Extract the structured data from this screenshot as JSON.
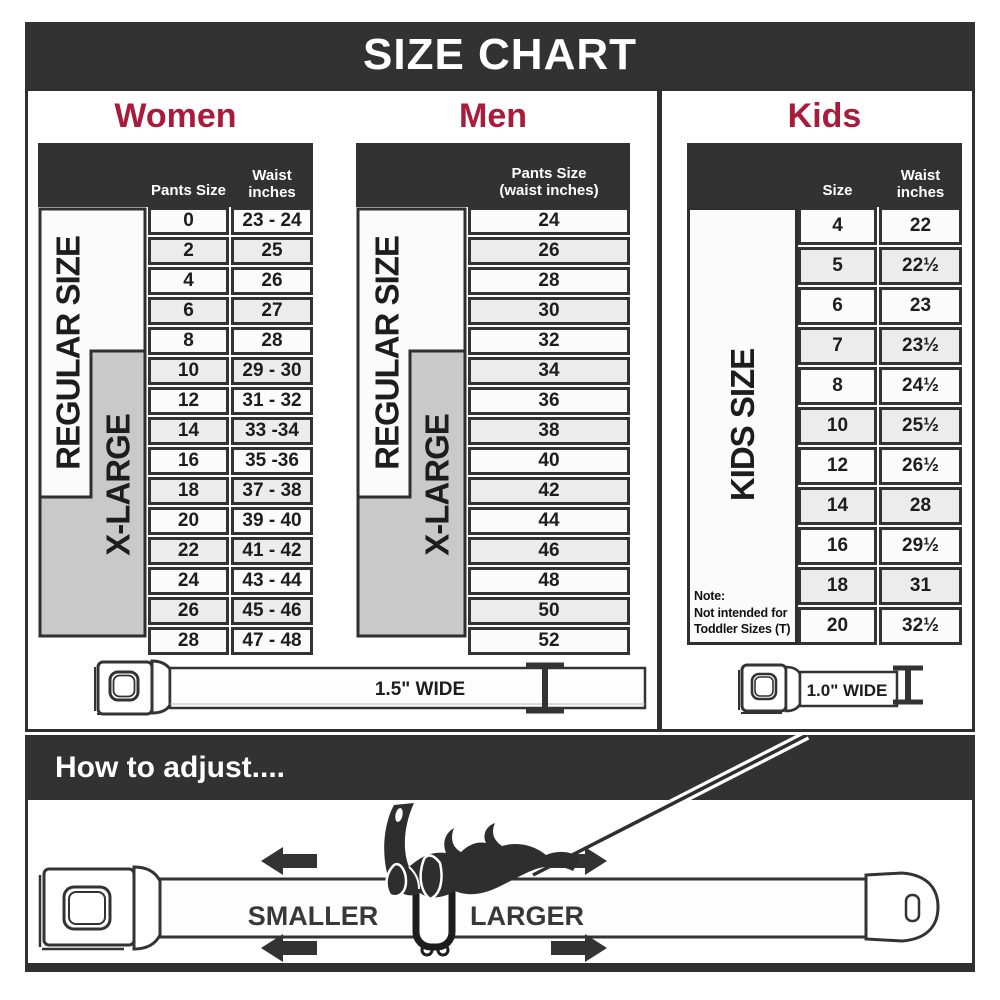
{
  "title": "SIZE CHART",
  "colors": {
    "dark": "#323232",
    "accent_red": "#a81b3b",
    "row_light": "#fbfbfb",
    "row_alt": "#ececec",
    "xlarge_gray": "#c9c9c9"
  },
  "women": {
    "heading": "Women",
    "regular_label": "REGULAR SIZE",
    "xlarge_label": "X-LARGE",
    "columns": {
      "pants": "Pants Size",
      "waist_line1": "Waist",
      "waist_line2": "inches"
    },
    "rows": [
      [
        "0",
        "23 - 24"
      ],
      [
        "2",
        "25"
      ],
      [
        "4",
        "26"
      ],
      [
        "6",
        "27"
      ],
      [
        "8",
        "28"
      ],
      [
        "10",
        "29 - 30"
      ],
      [
        "12",
        "31 - 32"
      ],
      [
        "14",
        "33 -34"
      ],
      [
        "16",
        "35 -36"
      ],
      [
        "18",
        "37 - 38"
      ],
      [
        "20",
        "39 - 40"
      ],
      [
        "22",
        "41 - 42"
      ],
      [
        "24",
        "43 - 44"
      ],
      [
        "26",
        "45 - 46"
      ],
      [
        "28",
        "47 - 48"
      ]
    ]
  },
  "men": {
    "heading": "Men",
    "regular_label": "REGULAR SIZE",
    "xlarge_label": "X-LARGE",
    "columns": {
      "line1": "Pants Size",
      "line2": "(waist inches)"
    },
    "rows": [
      "24",
      "26",
      "28",
      "30",
      "32",
      "34",
      "36",
      "38",
      "40",
      "42",
      "44",
      "46",
      "48",
      "50",
      "52"
    ]
  },
  "kids": {
    "heading": "Kids",
    "size_label": "KIDS SIZE",
    "columns": {
      "size": "Size",
      "waist_line1": "Waist",
      "waist_line2": "inches"
    },
    "rows": [
      [
        "4",
        "22"
      ],
      [
        "5",
        "22½"
      ],
      [
        "6",
        "23"
      ],
      [
        "7",
        "23½"
      ],
      [
        "8",
        "24½"
      ],
      [
        "10",
        "25½"
      ],
      [
        "12",
        "26½"
      ],
      [
        "14",
        "28"
      ],
      [
        "16",
        "29½"
      ],
      [
        "18",
        "31"
      ],
      [
        "20",
        "32½"
      ]
    ],
    "note_line1": "Note:",
    "note_line2": "Not intended for",
    "note_line3": "Toddler Sizes (T)"
  },
  "belts": {
    "adult_width_label": "1.5\" WIDE",
    "kids_width_label": "1.0\" WIDE"
  },
  "adjust": {
    "heading": "How to adjust....",
    "smaller": "SMALLER",
    "larger": "LARGER"
  }
}
